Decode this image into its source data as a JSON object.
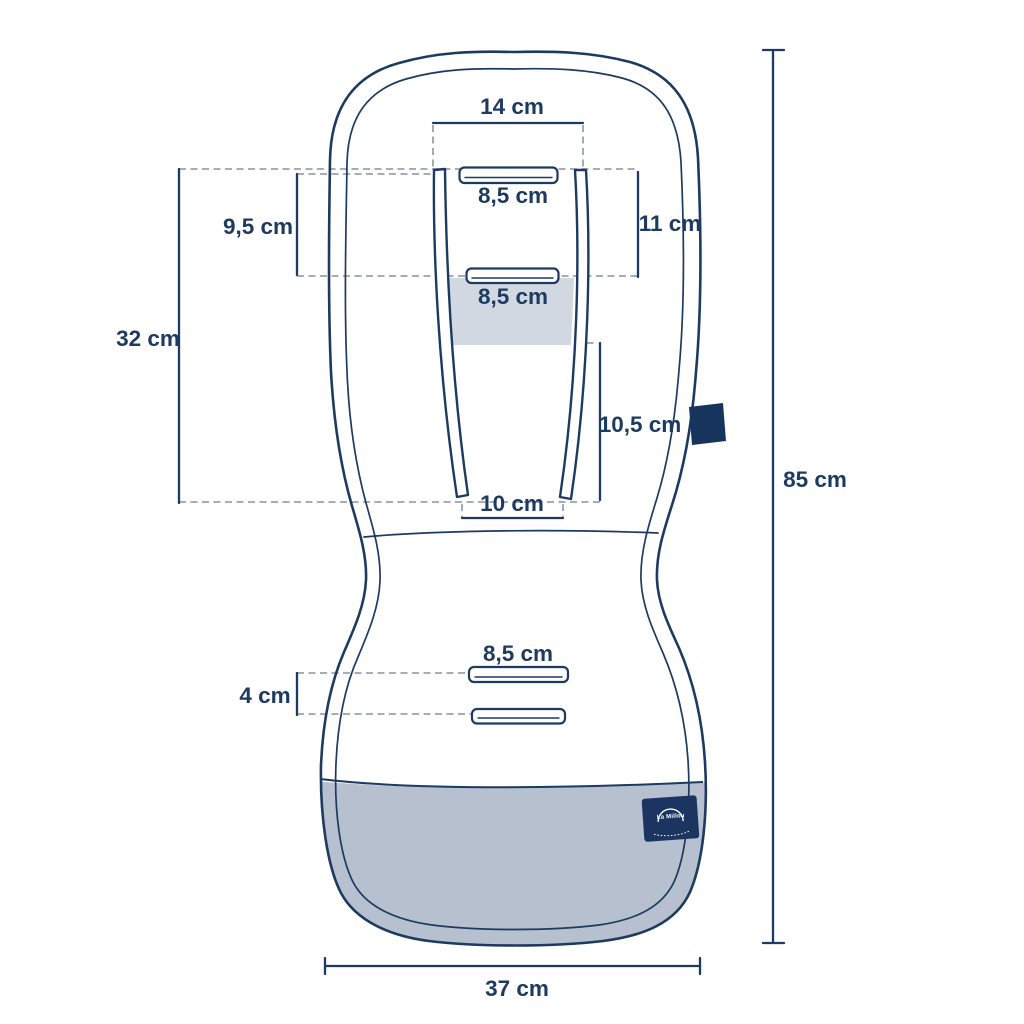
{
  "diagram": {
    "subject": "stroller-seat-liner-dimension-drawing",
    "unit": "cm"
  },
  "labels": {
    "top_width": "14 cm",
    "upper_slot_width": "8,5 cm",
    "upper_left_spacing": "9,5 cm",
    "upper_right_spacing": "11 cm",
    "mid_slot_width": "8,5 cm",
    "backrest_length": "32 cm",
    "lower_strap_length": "10,5 cm",
    "strap_bottom_gap": "10 cm",
    "seat_slot_width": "8,5 cm",
    "seat_slot_spacing": "4 cm",
    "total_length": "85 cm",
    "bottom_width": "37 cm"
  },
  "badge": {
    "brand": "La Millou"
  },
  "colors": {
    "line_navy": "#1d3a60",
    "dash_gray": "#98a3b1",
    "seat_fill_gray": "#b6c0ce",
    "shoulder_band_gray": "#d2d8e2",
    "tab_navy": "#17345c",
    "badge_navy": "#1b3560",
    "background": "#ffffff"
  }
}
